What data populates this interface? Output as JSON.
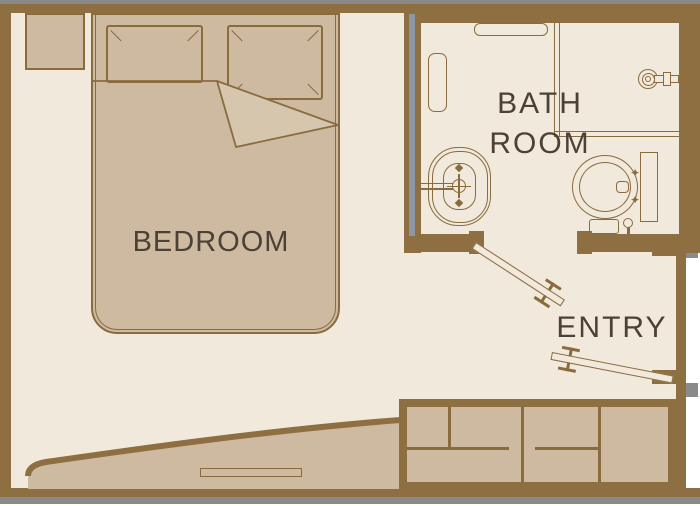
{
  "floor_plan": {
    "rooms": {
      "bedroom": {
        "label": "BEDROOM"
      },
      "bathroom": {
        "label_line1": "BATH",
        "label_line2": "ROOM"
      },
      "entry": {
        "label": "ENTRY"
      }
    },
    "fixtures": [
      "double-bed",
      "pillows",
      "nightstand",
      "bench-chaise",
      "wardrobe",
      "wash-basin",
      "toilet",
      "shower-head",
      "towel-rail-top",
      "towel-rail-side",
      "bathroom-door",
      "entry-door"
    ],
    "colors": {
      "background": "#ffffff",
      "wall": "#8d6f41",
      "line": "#8a6b3e",
      "floor": "#f1e9db",
      "furniture": "#cdbaa1",
      "furniture_light": "#d6c6ae",
      "label_text": "#4c4136",
      "shadow": "#8a8a8a",
      "wall_accent": "#8d97a4"
    }
  }
}
